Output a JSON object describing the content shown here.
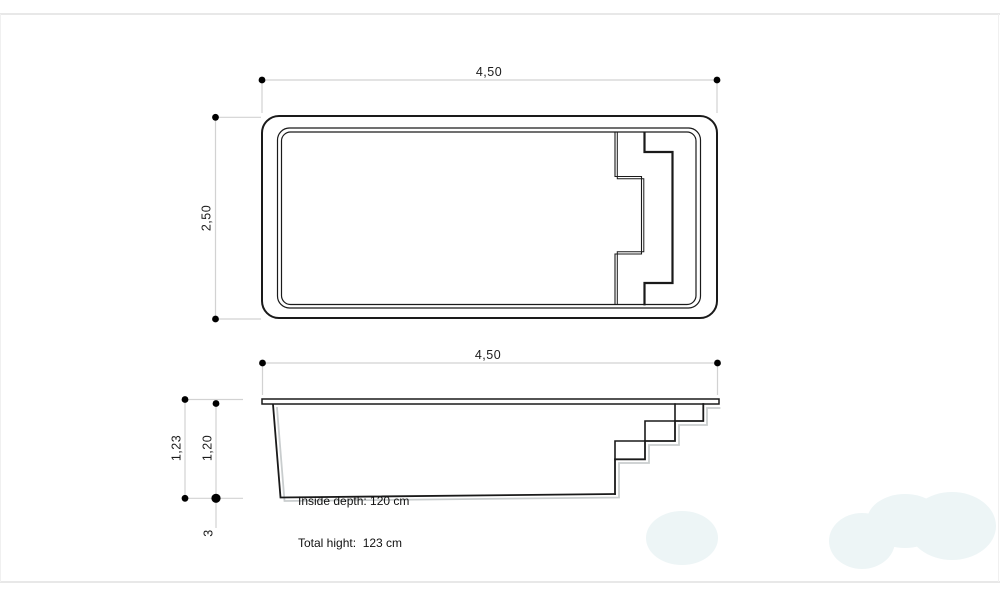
{
  "page": {
    "background": "#ffffff",
    "frame_color": "#e8e8e8",
    "watermark_color": "#edf5f6",
    "dimension_line_color": "#d2d2d2",
    "drawing_line_color": "#1a1a1a",
    "shadow_line_color": "#c9cdce"
  },
  "top_view": {
    "width_dim": "4,50",
    "height_dim": "2,50"
  },
  "section_view": {
    "width_dim": "4,50",
    "total_height_dim": "1,23",
    "inside_depth_dim": "1,20",
    "deck_thickness_dim": "3",
    "annotation": {
      "line1": "Inside depth: 120 cm",
      "line2": "Total hight:  123 cm"
    }
  }
}
